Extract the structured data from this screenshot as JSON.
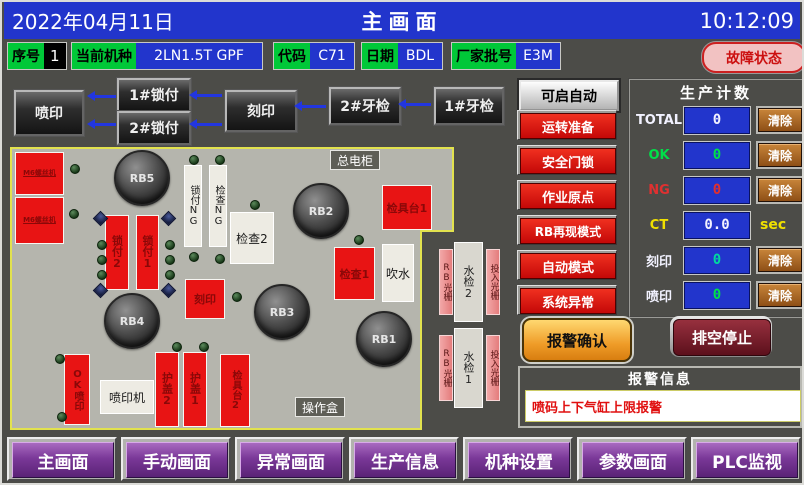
{
  "topbar": {
    "date": "2022年04月11日",
    "title": "主画面",
    "time": "10:12:09"
  },
  "info_row": {
    "seq_label": "序号",
    "seq_value": "1",
    "model_label": "当前机种",
    "model_value": "2LN1.5T GPF",
    "code_label": "代码",
    "code_value": "C71",
    "date_label": "日期",
    "date_value": "BDL",
    "batch_label": "厂家批号",
    "batch_value": "E3M",
    "fault_button": "故障状态"
  },
  "flow": {
    "print": "喷印",
    "lock1": "1#锁付",
    "lock2": "2#锁付",
    "engrave": "刻印",
    "thread2": "2#牙检",
    "thread1": "1#牙检"
  },
  "machine": {
    "feeder1": "M6螺丝机",
    "feeder2": "M6螺丝机",
    "rb5": "RB5",
    "rb4": "RB4",
    "rb3": "RB3",
    "rb2": "RB2",
    "rb1": "RB1",
    "lock_ng": "锁付NG",
    "check_ng": "检查NG",
    "main_cabinet": "总电柜",
    "op_box": "操作盒",
    "fixture1": "检具台1",
    "fixture2": "检具台2",
    "lock_st2": "锁付2",
    "lock_st1": "锁付1",
    "check2": "检查2",
    "check1": "检查1",
    "blow": "吹水",
    "engrave": "刻印",
    "ok_print": "OK喷印",
    "printer": "喷印机",
    "cover2": "护盖2",
    "cover1": "护盖1",
    "rb_grating_a": "RB光栅",
    "input_grating_a": "投入光栅",
    "water2": "水检2",
    "rb_grating_b": "RB光栅",
    "input_grating_b": "投入光栅",
    "water1": "水检1"
  },
  "right_panel": {
    "auto_ready": "可启自动",
    "status_buttons": [
      "运转准备",
      "安全门锁",
      "作业原点",
      "RB再现模式",
      "自动模式",
      "系统异常"
    ]
  },
  "production": {
    "title": "生产计数",
    "rows": [
      {
        "label": "TOTAL",
        "value": "0",
        "action": "清除"
      },
      {
        "label": "OK",
        "value": "0",
        "action": "清除"
      },
      {
        "label": "NG",
        "value": "0",
        "action": "清除"
      },
      {
        "label": "CT",
        "value": "0.0",
        "unit": "sec"
      },
      {
        "label": "刻印",
        "value": "0",
        "action": "清除"
      },
      {
        "label": "喷印",
        "value": "0",
        "action": "清除"
      }
    ]
  },
  "alarm": {
    "confirm": "报警确认",
    "stop": "排空停止",
    "title": "报警信息",
    "message": "喷码上下气缸上限报警"
  },
  "nav": [
    "主画面",
    "手动画面",
    "异常画面",
    "生产信息",
    "机种设置",
    "参数画面",
    "PLC监视"
  ],
  "colors": {
    "topbar_blue": "#2235cc",
    "label_green": "#00c838",
    "alarm_red": "#e81414",
    "status_red": "#c40808",
    "nav_purple": "#7a3898",
    "clear_brown": "#a06028",
    "confirm_orange": "#ef9c28",
    "stop_maroon": "#5c101c",
    "border_yellow": "#e2e24e",
    "ok_green": "#00e04a",
    "ng_red": "#e03030",
    "ct_yellow": "#f0e000"
  }
}
